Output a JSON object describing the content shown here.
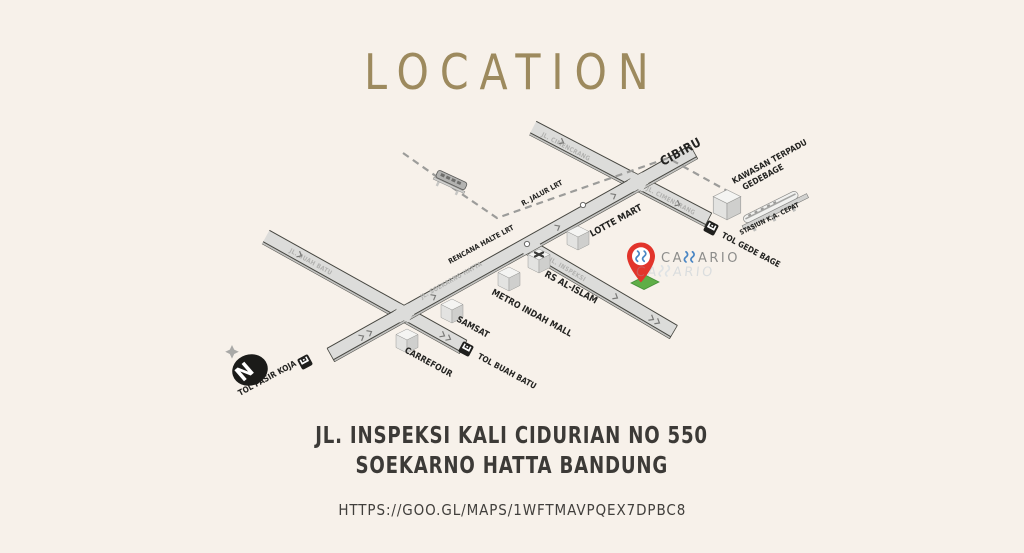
{
  "page": {
    "title": "LOCATION",
    "background": "#f7f1ea",
    "accent_color": "#9d8a5e"
  },
  "address": {
    "line1": "JL. INSPEKSI KALI CIDURIAN NO 550",
    "line2": "SOEKARNO HATTA BANDUNG",
    "map_link": "HTTPS://GOO.GL/MAPS/1WFTMAVPQEX7DPBC8"
  },
  "map": {
    "compass": {
      "north_label": "N"
    },
    "logo": {
      "brand": "CASSARIO",
      "wordmark_prefix": "CA",
      "wordmark_suffix": "ARIO",
      "pin_color": "#e2342b",
      "steam_color": "#4a86c4",
      "marker_base_color": "#5fae47"
    },
    "road_names": {
      "soekarno_hatta": "JL. SOEKARNO HATTA",
      "cimencrang_upper": "JL. CIMENCRANG",
      "cimencrang_lower": "JL. CIMENCRANG",
      "inspeksi": "JL. INSPEKSI",
      "buah_batu": "JL. BUAH BATU"
    },
    "labels": {
      "cibiru": "CIBIRU",
      "kawasan_line1": "KAWASAN TERPADU",
      "kawasan_line2": "GEDEBAGE",
      "stasiun_ka_cepat": "STASIUN K.A. CEPAT",
      "tol_gede_bage": "TOL GEDE BAGE",
      "lotte_mart": "LOTTE MART",
      "rs_al_islam": "RS AL-ISLAM",
      "metro_indah_mall": "METRO INDAH MALL",
      "samsat": "SAMSAT",
      "carrefour": "CARREFOUR",
      "tol_buah_batu": "TOL BUAH BATU",
      "tol_pasir_koja": "TOL PASIR KOJA",
      "r_jalur_lrt": "R. JALUR LRT",
      "rencana_halte_lrt": "RENCANA HALTE LRT"
    }
  }
}
